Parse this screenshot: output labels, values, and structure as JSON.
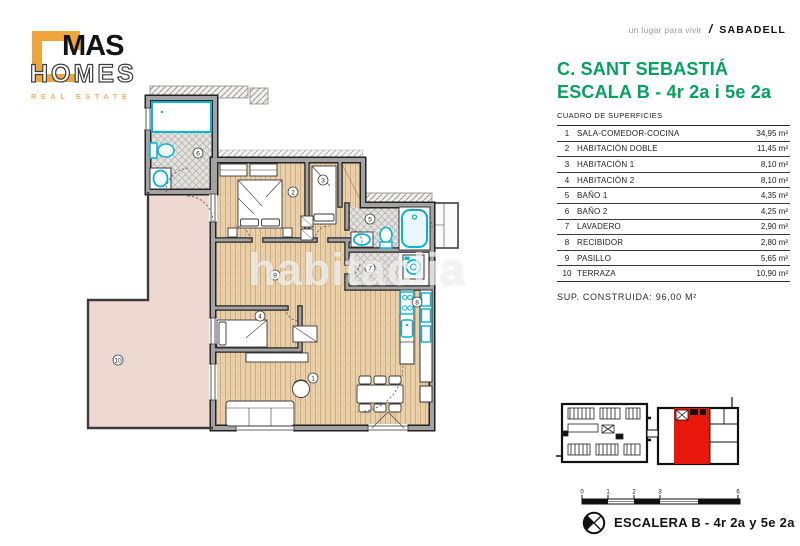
{
  "brand": {
    "name_top": "MAS",
    "name_bottom": "HOMES",
    "tagline": "REAL ESTATE"
  },
  "header": {
    "slogan": "un lugar para vivir",
    "separator": "/",
    "location": "SABADELL"
  },
  "panel": {
    "title_line1": "C. SANT SEBASTIÁ",
    "title_line2": "ESCALA B - 4r 2a i 5e 2a",
    "table_heading": "CUADRO DE SUPERFICIES",
    "rows": [
      {
        "num": "1",
        "name": "SALA-COMEDOR-COCINA",
        "area": "34,95 m²"
      },
      {
        "num": "2",
        "name": "HABITACIÓN DOBLE",
        "area": "11,45 m²"
      },
      {
        "num": "3",
        "name": "HABITACIÓN 1",
        "area": "8,10 m²"
      },
      {
        "num": "4",
        "name": "HABITACIÓN 2",
        "area": "8,10 m²"
      },
      {
        "num": "5",
        "name": "BAÑO 1",
        "area": "4,35 m²"
      },
      {
        "num": "6",
        "name": "BAÑO 2",
        "area": "4,25 m²"
      },
      {
        "num": "7",
        "name": "LAVADERO",
        "area": "2,90 m²"
      },
      {
        "num": "8",
        "name": "RECIBIDOR",
        "area": "2,80 m²"
      },
      {
        "num": "9",
        "name": "PASILLO",
        "area": "5,65 m²"
      },
      {
        "num": "10",
        "name": "TERRAZA",
        "area": "10,90 m²"
      }
    ],
    "total": "SUP. CONSTRUIDA: 96,00 M²",
    "scale_labels": [
      "0",
      "1",
      "2",
      "3",
      "6"
    ],
    "footer_label": "ESCALERA B - 4r 2a y 5e 2a"
  },
  "floorplan": {
    "watermark": "habitaclia",
    "rooms": [
      {
        "num": "1"
      },
      {
        "num": "2"
      },
      {
        "num": "3"
      },
      {
        "num": "4"
      },
      {
        "num": "5"
      },
      {
        "num": "6"
      },
      {
        "num": "7"
      },
      {
        "num": "8"
      },
      {
        "num": "9"
      },
      {
        "num": "10"
      }
    ]
  },
  "colors": {
    "accent_green": "#00a45e",
    "brand_orange": "#f0a43c",
    "unit_red": "#e8170c",
    "fixture_cyan": "#00b6d9",
    "wood_floor": "#ead1a9",
    "terrace_pink": "#edd9d2"
  }
}
